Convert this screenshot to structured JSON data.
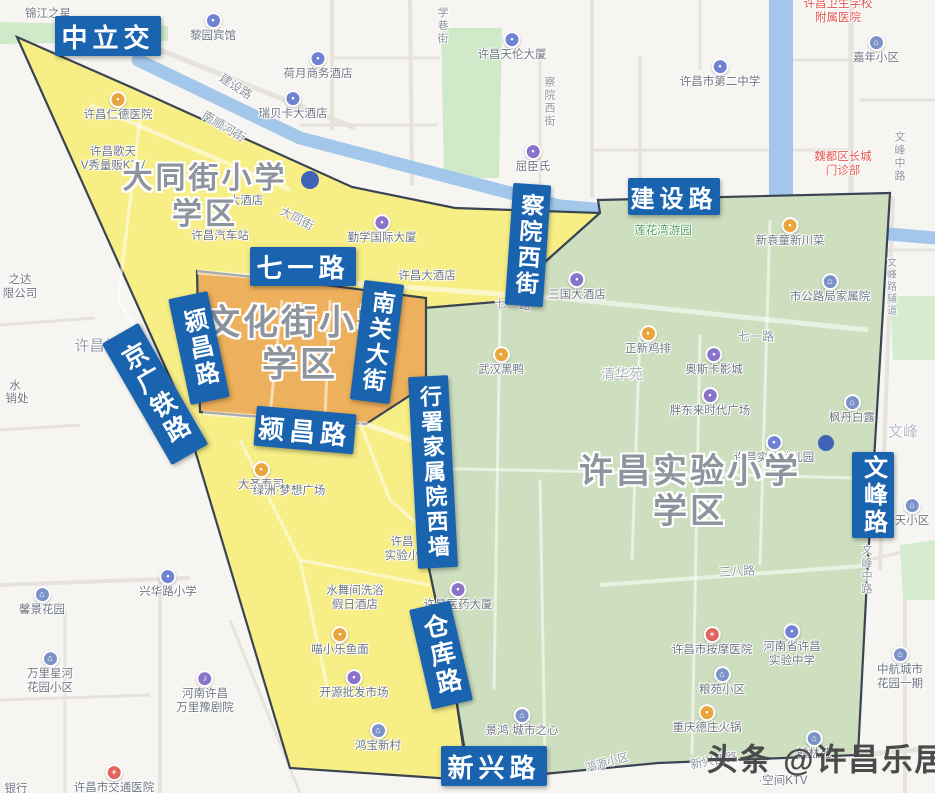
{
  "map": {
    "watermark": {
      "text": "头条 @许昌乐居",
      "x": 827,
      "y": 757,
      "fs": 31
    },
    "colors": {
      "label_bg": "#1a64af",
      "zone_yellow": "#f7ee86",
      "zone_orange": "#edb05c",
      "zone_green": "#cedfc0",
      "river": "#a3c7ea",
      "zone_border": "#3a4553"
    },
    "zones": [
      {
        "id": "datong",
        "fill": "#f7ee86",
        "title": {
          "lines": [
            "大同街小学",
            "学区"
          ],
          "x": 205,
          "y": 193,
          "fs": 30
        }
      },
      {
        "id": "wenhua",
        "fill": "#edb05c",
        "title": {
          "lines": [
            "文化街小学",
            "学区"
          ],
          "x": 300,
          "y": 341,
          "fs": 35
        }
      },
      {
        "id": "shiyan",
        "fill": "#cedfc0",
        "title": {
          "lines": [
            "许昌实验小学",
            "学区"
          ],
          "x": 690,
          "y": 488,
          "fs": 34
        }
      }
    ],
    "road_labels": [
      {
        "text": "中立交",
        "x": 108,
        "y": 36,
        "w": 106,
        "h": 40,
        "fs": 26,
        "rot": 0,
        "vertical": false
      },
      {
        "text": "建设路",
        "x": 674,
        "y": 196,
        "w": 92,
        "h": 37,
        "fs": 24,
        "rot": 0,
        "vertical": false
      },
      {
        "text": "察院西街",
        "x": 528,
        "y": 245,
        "w": 38,
        "h": 122,
        "fs": 23,
        "rot": 4,
        "vertical": true
      },
      {
        "text": "七一路",
        "x": 303,
        "y": 266,
        "w": 106,
        "h": 39,
        "fs": 26,
        "rot": 0,
        "vertical": false
      },
      {
        "text": "颍昌路",
        "x": 199,
        "y": 348,
        "w": 40,
        "h": 108,
        "fs": 24,
        "rot": -12,
        "vertical": true
      },
      {
        "text": "南关大街",
        "x": 377,
        "y": 342,
        "w": 40,
        "h": 120,
        "fs": 23,
        "rot": 7,
        "vertical": true
      },
      {
        "text": "京广铁路",
        "x": 155,
        "y": 394,
        "w": 42,
        "h": 140,
        "fs": 25,
        "rot": -30,
        "vertical": true
      },
      {
        "text": "颍昌路",
        "x": 305,
        "y": 430,
        "w": 100,
        "h": 40,
        "fs": 26,
        "rot": 5,
        "vertical": false
      },
      {
        "text": "行署家属院西墙",
        "x": 433,
        "y": 472,
        "w": 40,
        "h": 192,
        "fs": 22,
        "rot": -3,
        "vertical": true
      },
      {
        "text": "仓库路",
        "x": 441,
        "y": 655,
        "w": 42,
        "h": 102,
        "fs": 25,
        "rot": -13,
        "vertical": true
      },
      {
        "text": "新兴路",
        "x": 494,
        "y": 766,
        "w": 106,
        "h": 40,
        "fs": 26,
        "rot": 0,
        "vertical": false
      },
      {
        "text": "文峰路",
        "x": 873,
        "y": 495,
        "w": 42,
        "h": 86,
        "fs": 24,
        "rot": 0,
        "vertical": true
      }
    ],
    "street_labels": [
      {
        "text": "建设路",
        "x": 236,
        "y": 86,
        "rot": 33,
        "fs": 12,
        "vertical": false
      },
      {
        "text": "南顺河街",
        "x": 224,
        "y": 126,
        "rot": 31,
        "fs": 12,
        "vertical": false
      },
      {
        "text": "大同街",
        "x": 297,
        "y": 218,
        "rot": 27,
        "fs": 12,
        "vertical": false
      },
      {
        "text": "学巷街",
        "x": 442,
        "y": 26,
        "rot": 0,
        "fs": 11,
        "vertical": true
      },
      {
        "text": "察院西街",
        "x": 549,
        "y": 102,
        "rot": 0,
        "fs": 11,
        "vertical": true
      },
      {
        "text": "七一路",
        "x": 513,
        "y": 304,
        "rot": 4,
        "fs": 12,
        "vertical": false
      },
      {
        "text": "七一路",
        "x": 756,
        "y": 336,
        "rot": 0,
        "fs": 12,
        "vertical": false
      },
      {
        "text": "三八路",
        "x": 737,
        "y": 571,
        "rot": -3,
        "fs": 12,
        "vertical": false
      },
      {
        "text": "新兴西路",
        "x": 714,
        "y": 760,
        "rot": -10,
        "fs": 12,
        "vertical": false
      },
      {
        "text": "鸿源小区",
        "x": 607,
        "y": 762,
        "rot": -15,
        "fs": 11,
        "vertical": false
      },
      {
        "text": "文峰中路",
        "x": 899,
        "y": 157,
        "rot": 0,
        "fs": 11,
        "vertical": true
      },
      {
        "text": "文峰路辅道",
        "x": 890,
        "y": 287,
        "rot": 0,
        "fs": 10,
        "vertical": true
      },
      {
        "text": "文峰中路",
        "x": 866,
        "y": 570,
        "rot": 0,
        "fs": 11,
        "vertical": true
      },
      {
        "text": "许昌站",
        "x": 97,
        "y": 345,
        "rot": 0,
        "fs": 15,
        "vertical": false,
        "color": "#99a1ac"
      },
      {
        "text": "清华苑",
        "x": 622,
        "y": 374,
        "rot": 0,
        "fs": 14,
        "vertical": false,
        "color": "#aab0ba"
      },
      {
        "text": "文峰",
        "x": 903,
        "y": 431,
        "rot": 0,
        "fs": 15,
        "vertical": false,
        "color": "#b5bcc4"
      }
    ],
    "pois": [
      {
        "lines": [
          "锦江之星"
        ],
        "x": 48,
        "y": 15
      },
      {
        "lines": [
          "黎园宾馆"
        ],
        "x": 213,
        "y": 28,
        "icon": {
          "color": "#6f82d4",
          "glyph": "•"
        }
      },
      {
        "lines": [
          "荷月商务酒店"
        ],
        "x": 318,
        "y": 66,
        "icon": {
          "color": "#6f82d4",
          "glyph": "•"
        }
      },
      {
        "lines": [
          "瑞贝卡大酒店"
        ],
        "x": 293,
        "y": 106,
        "icon": {
          "color": "#6f82d4",
          "glyph": "•"
        }
      },
      {
        "lines": [
          "许昌天伦大厦"
        ],
        "x": 512,
        "y": 47,
        "icon": {
          "color": "#6f82d4",
          "glyph": "•"
        }
      },
      {
        "lines": [
          "许昌市第二中学"
        ],
        "x": 720,
        "y": 74,
        "icon": {
          "color": "#6f82d4",
          "glyph": "•"
        }
      },
      {
        "lines": [
          "许昌卫生学校",
          "附属医院"
        ],
        "x": 838,
        "y": 12,
        "color": "#e25750"
      },
      {
        "lines": [
          "嘉年小区"
        ],
        "x": 876,
        "y": 50,
        "icon": {
          "color": "#7b92c9",
          "glyph": "⌂"
        }
      },
      {
        "lines": [
          "魏都区长城",
          "门诊部"
        ],
        "x": 843,
        "y": 165,
        "color": "#e25750"
      },
      {
        "lines": [
          "屈臣氏"
        ],
        "x": 533,
        "y": 159,
        "icon": {
          "color": "#8a74c9",
          "glyph": "•"
        }
      },
      {
        "lines": [
          "许昌仁德医院"
        ],
        "x": 118,
        "y": 107,
        "icon": {
          "color": "#e9a43c",
          "glyph": "•"
        }
      },
      {
        "lines": [
          "许昌歌天",
          "V秀量贩KTV"
        ],
        "x": 113,
        "y": 160
      },
      {
        "lines": [
          "大酒店"
        ],
        "x": 246,
        "y": 202
      },
      {
        "lines": [
          "许昌汽车站"
        ],
        "x": 220,
        "y": 237
      },
      {
        "lines": [
          "勤学国际大厦"
        ],
        "x": 382,
        "y": 230,
        "icon": {
          "color": "#8a74c9",
          "glyph": "•"
        }
      },
      {
        "lines": [
          "莲花湾游园"
        ],
        "x": 663,
        "y": 232,
        "color": "#53a25c"
      },
      {
        "lines": [
          "新袁童新川菜"
        ],
        "x": 790,
        "y": 233,
        "icon": {
          "color": "#e9a43c",
          "glyph": "•"
        }
      },
      {
        "lines": [
          "三国大酒店"
        ],
        "x": 577,
        "y": 287,
        "icon": {
          "color": "#8a74c9",
          "glyph": "•"
        }
      },
      {
        "lines": [
          "许昌大酒店"
        ],
        "x": 427,
        "y": 277
      },
      {
        "lines": [
          "武汉黑鸭"
        ],
        "x": 501,
        "y": 362,
        "icon": {
          "color": "#e9a43c",
          "glyph": "•"
        }
      },
      {
        "lines": [
          "正新鸡排"
        ],
        "x": 648,
        "y": 341,
        "icon": {
          "color": "#e9a43c",
          "glyph": "•"
        }
      },
      {
        "lines": [
          "奥斯卡影城"
        ],
        "x": 714,
        "y": 362,
        "icon": {
          "color": "#8a74c9",
          "glyph": "•"
        }
      },
      {
        "lines": [
          "胖东来时代广场"
        ],
        "x": 710,
        "y": 403,
        "icon": {
          "color": "#8a74c9",
          "glyph": "•"
        }
      },
      {
        "lines": [
          "市公路局家属院"
        ],
        "x": 830,
        "y": 289,
        "icon": {
          "color": "#7b92c9",
          "glyph": "⌂"
        }
      },
      {
        "lines": [
          "枫丹白露"
        ],
        "x": 852,
        "y": 410,
        "icon": {
          "color": "#7b92c9",
          "glyph": "⌂"
        }
      },
      {
        "lines": [
          "许昌实验幼儿园"
        ],
        "x": 774,
        "y": 450,
        "icon": {
          "color": "#6f82d4",
          "glyph": "•"
        }
      },
      {
        "lines": [
          "许昌市按摩医院"
        ],
        "x": 712,
        "y": 642,
        "icon": {
          "color": "#e2635c",
          "glyph": "+"
        }
      },
      {
        "lines": [
          "河南省许昌",
          "实验中学"
        ],
        "x": 792,
        "y": 646,
        "icon": {
          "color": "#6f82d4",
          "glyph": "•"
        }
      },
      {
        "lines": [
          "粮苑小区"
        ],
        "x": 722,
        "y": 682,
        "icon": {
          "color": "#7b92c9",
          "glyph": "⌂"
        }
      },
      {
        "lines": [
          "重庆德庄火锅"
        ],
        "x": 707,
        "y": 720,
        "icon": {
          "color": "#e9a43c",
          "glyph": "•"
        }
      },
      {
        "lines": [
          "翰林苑"
        ],
        "x": 814,
        "y": 746,
        "icon": {
          "color": "#7b92c9",
          "glyph": "⌂"
        }
      },
      {
        "lines": [
          "中航城市",
          "花园一期"
        ],
        "x": 900,
        "y": 669,
        "icon": {
          "color": "#7b92c9",
          "glyph": "⌂"
        }
      },
      {
        "lines": [
          "景鸿·城市之心"
        ],
        "x": 522,
        "y": 723,
        "icon": {
          "color": "#7b92c9",
          "glyph": "⌂"
        }
      },
      {
        "lines": [
          "许昌医药大厦"
        ],
        "x": 458,
        "y": 597,
        "icon": {
          "color": "#8a74c9",
          "glyph": "•"
        }
      },
      {
        "lines": [
          "水舞间洗浴",
          "假日酒店"
        ],
        "x": 355,
        "y": 599
      },
      {
        "lines": [
          "喵小乐鱼面"
        ],
        "x": 340,
        "y": 642,
        "icon": {
          "color": "#e9a43c",
          "glyph": "•"
        }
      },
      {
        "lines": [
          "开源批发市场"
        ],
        "x": 354,
        "y": 685,
        "icon": {
          "color": "#8a74c9",
          "glyph": "•"
        }
      },
      {
        "lines": [
          "鸿宝新村"
        ],
        "x": 378,
        "y": 738,
        "icon": {
          "color": "#7b92c9",
          "glyph": "⌂"
        }
      },
      {
        "lines": [
          "许昌",
          "实验小"
        ],
        "x": 402,
        "y": 550
      },
      {
        "lines": [
          "兴华路小学"
        ],
        "x": 168,
        "y": 584,
        "icon": {
          "color": "#6f82d4",
          "glyph": "•"
        }
      },
      {
        "lines": [
          "馨景花园"
        ],
        "x": 42,
        "y": 602,
        "icon": {
          "color": "#7b92c9",
          "glyph": "⌂"
        }
      },
      {
        "lines": [
          "万里星河",
          "花园小区"
        ],
        "x": 50,
        "y": 673,
        "icon": {
          "color": "#7b92c9",
          "glyph": "⌂"
        }
      },
      {
        "lines": [
          "河南许昌",
          "万里豫剧院"
        ],
        "x": 205,
        "y": 693,
        "icon": {
          "color": "#8a74c9",
          "glyph": "♪"
        }
      },
      {
        "lines": [
          "许昌市交通医院"
        ],
        "x": 114,
        "y": 780,
        "icon": {
          "color": "#e2635c",
          "glyph": "+"
        }
      },
      {
        "lines": [
          "之达",
          "限公司"
        ],
        "x": 20,
        "y": 288
      },
      {
        "lines": [
          "大圣寿司"
        ],
        "x": 261,
        "y": 477,
        "icon": {
          "color": "#e9a43c",
          "glyph": "•"
        }
      },
      {
        "lines": [
          "绿洲·梦想广场"
        ],
        "x": 289,
        "y": 492
      },
      {
        "lines": [
          "·空间KTV"
        ],
        "x": 783,
        "y": 782
      },
      {
        "lines": [
          "天小区"
        ],
        "x": 912,
        "y": 513,
        "icon": {
          "color": "#7b92c9",
          "glyph": "⌂"
        }
      },
      {
        "lines": [
          "银行"
        ],
        "x": 16,
        "y": 790
      },
      {
        "lines": [
          "水"
        ],
        "x": 15,
        "y": 387
      },
      {
        "lines": [
          "销处"
        ],
        "x": 17,
        "y": 400
      }
    ],
    "dots": [
      {
        "x": 310,
        "y": 180,
        "r": 9
      },
      {
        "x": 826,
        "y": 443,
        "r": 8
      }
    ]
  }
}
